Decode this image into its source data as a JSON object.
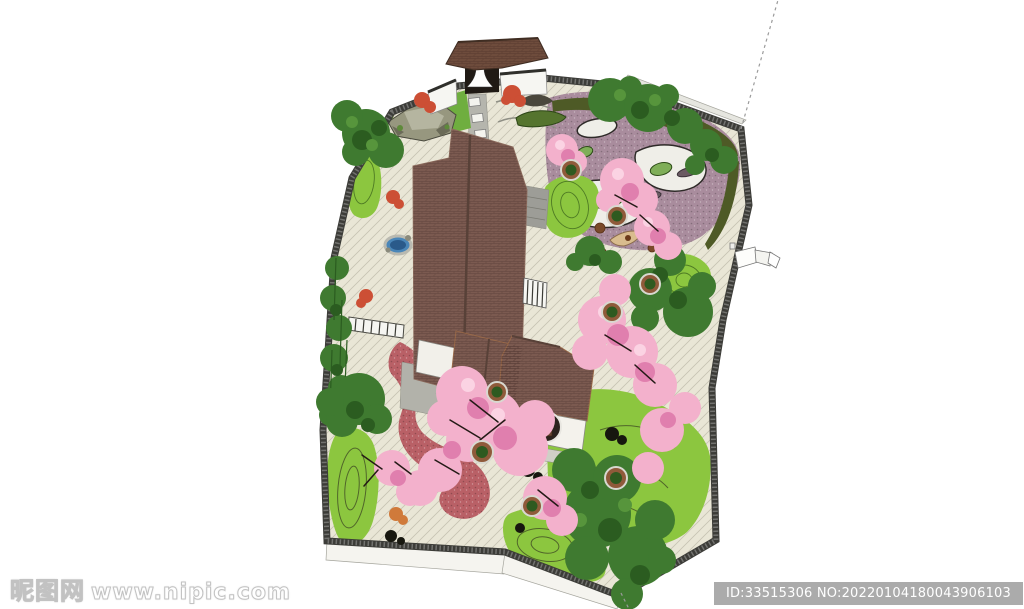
{
  "artwork": {
    "title": "Chinese courtyard garden aerial rendering",
    "style": "SketchUp-style 3D landscape design render, top-down aerial view"
  },
  "watermark": {
    "logo_text": "昵图网",
    "site_text": "www.nipic.com"
  },
  "id_badge": {
    "text": "ID:33515306 NO:20220104180043906103",
    "background": "#ababab",
    "text_color": "#ffffff"
  },
  "palette": {
    "paving": "#e9e6d6",
    "roof_brown": "#7b5a50",
    "gate_roof": "#6e4c3c",
    "wall_dark": "#3c3c38",
    "white_face": "#f5f4ef",
    "outer_face": "#dcdcd6",
    "lawn_green": "#8cc63f",
    "contour_green": "#4e7a24",
    "tree_green": "#3f7a30",
    "tree_dark": "#2b5c20",
    "tree_light": "#57953c",
    "hedge_olive": "#4e5a26",
    "purple_gravel": "#a98c9d",
    "sand_white": "#efeee8",
    "island_green": "#7fae58",
    "blossom_pink": "#f3b1cc",
    "blossom_dark": "#e07fae",
    "blossom_light": "#fbd3e3",
    "path_red": "#b96066",
    "pond_blue": "#4a86b8",
    "maple_red": "#cc4f35",
    "maple_orange": "#d07a3a",
    "bench_tan": "#d9bc8e",
    "pot_brown": "#8f5a3a",
    "pot_plant": "#2e5a20",
    "walkway_gray": "#9d9d97",
    "terrace_gray": "#b2b2aa",
    "grass_bright": "#6fae3f",
    "badge_gray": "#ababab",
    "dashed_line_gray": "#9a9a9a"
  },
  "scene": {
    "elements": [
      "perimeter-wall",
      "entrance-gate",
      "main-hall-roof",
      "pavilion",
      "moon-window",
      "rock-garden",
      "purple-gravel-garden",
      "sand-stream",
      "lawn-mounds",
      "cherry-blossom-trees",
      "planter-pots",
      "green-trees",
      "red-maples",
      "winding-red-path",
      "stepping-stone-path",
      "pond-basin",
      "tea-seating-area",
      "railing",
      "side-gate-structure",
      "boundary-dashed-line"
    ]
  }
}
